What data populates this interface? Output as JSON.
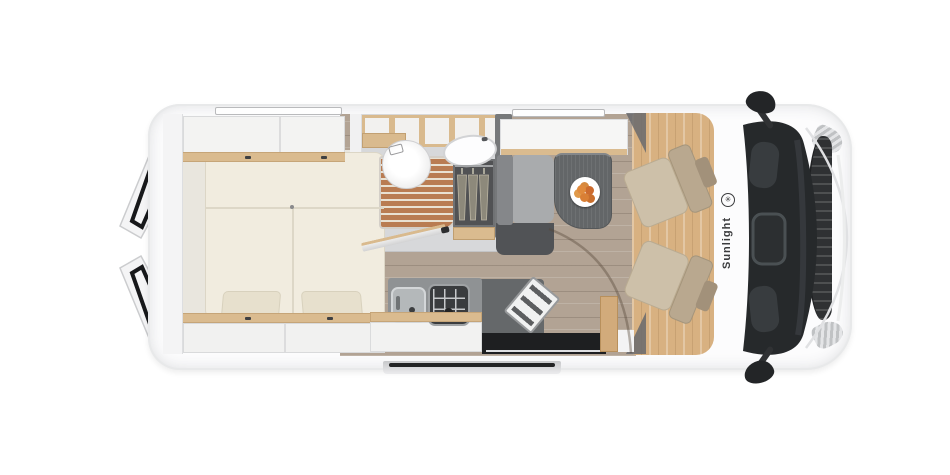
{
  "title": "Sunlight camper van floor plan - top view",
  "brand": {
    "name": "Sunlight",
    "logo_glyph": "✳"
  },
  "palette": {
    "background": "#ffffff",
    "body_shell": "#fcfcfd",
    "wall_trim": "#e8e9ea",
    "wood_trim": "#dabb8f",
    "living_floor": "#b2a394",
    "cab_floor": "#d8b181",
    "shower_slats": "#c08055",
    "mattress_cream": "#f1ecdf",
    "upholstery_beige": "#cdc0a9",
    "bench_gray": "#a9abad",
    "table_gray": "#636668",
    "counter_gray": "#8f9294",
    "glass_dark": "#26292b",
    "accent_red": "#b23125",
    "fruit_orange": "#e08a3c"
  },
  "components": {
    "rear_doors": "open rear barn doors",
    "bed": "transverse double bed with two pillows",
    "lockers": "overhead storage lockers with oak rails",
    "bathroom": "wet room with toilet, washbasin and wooden shower grate",
    "wardrobe": "wardrobe with three hangers",
    "dinette": "bench seat and table with fruit plate",
    "kitchen": "kitchenette with sink and hob",
    "entry": "sliding entry door with exterior step",
    "cab": "driver cab with two swivel seats",
    "front_end": "windshield, grille, headlights and mirrors"
  }
}
